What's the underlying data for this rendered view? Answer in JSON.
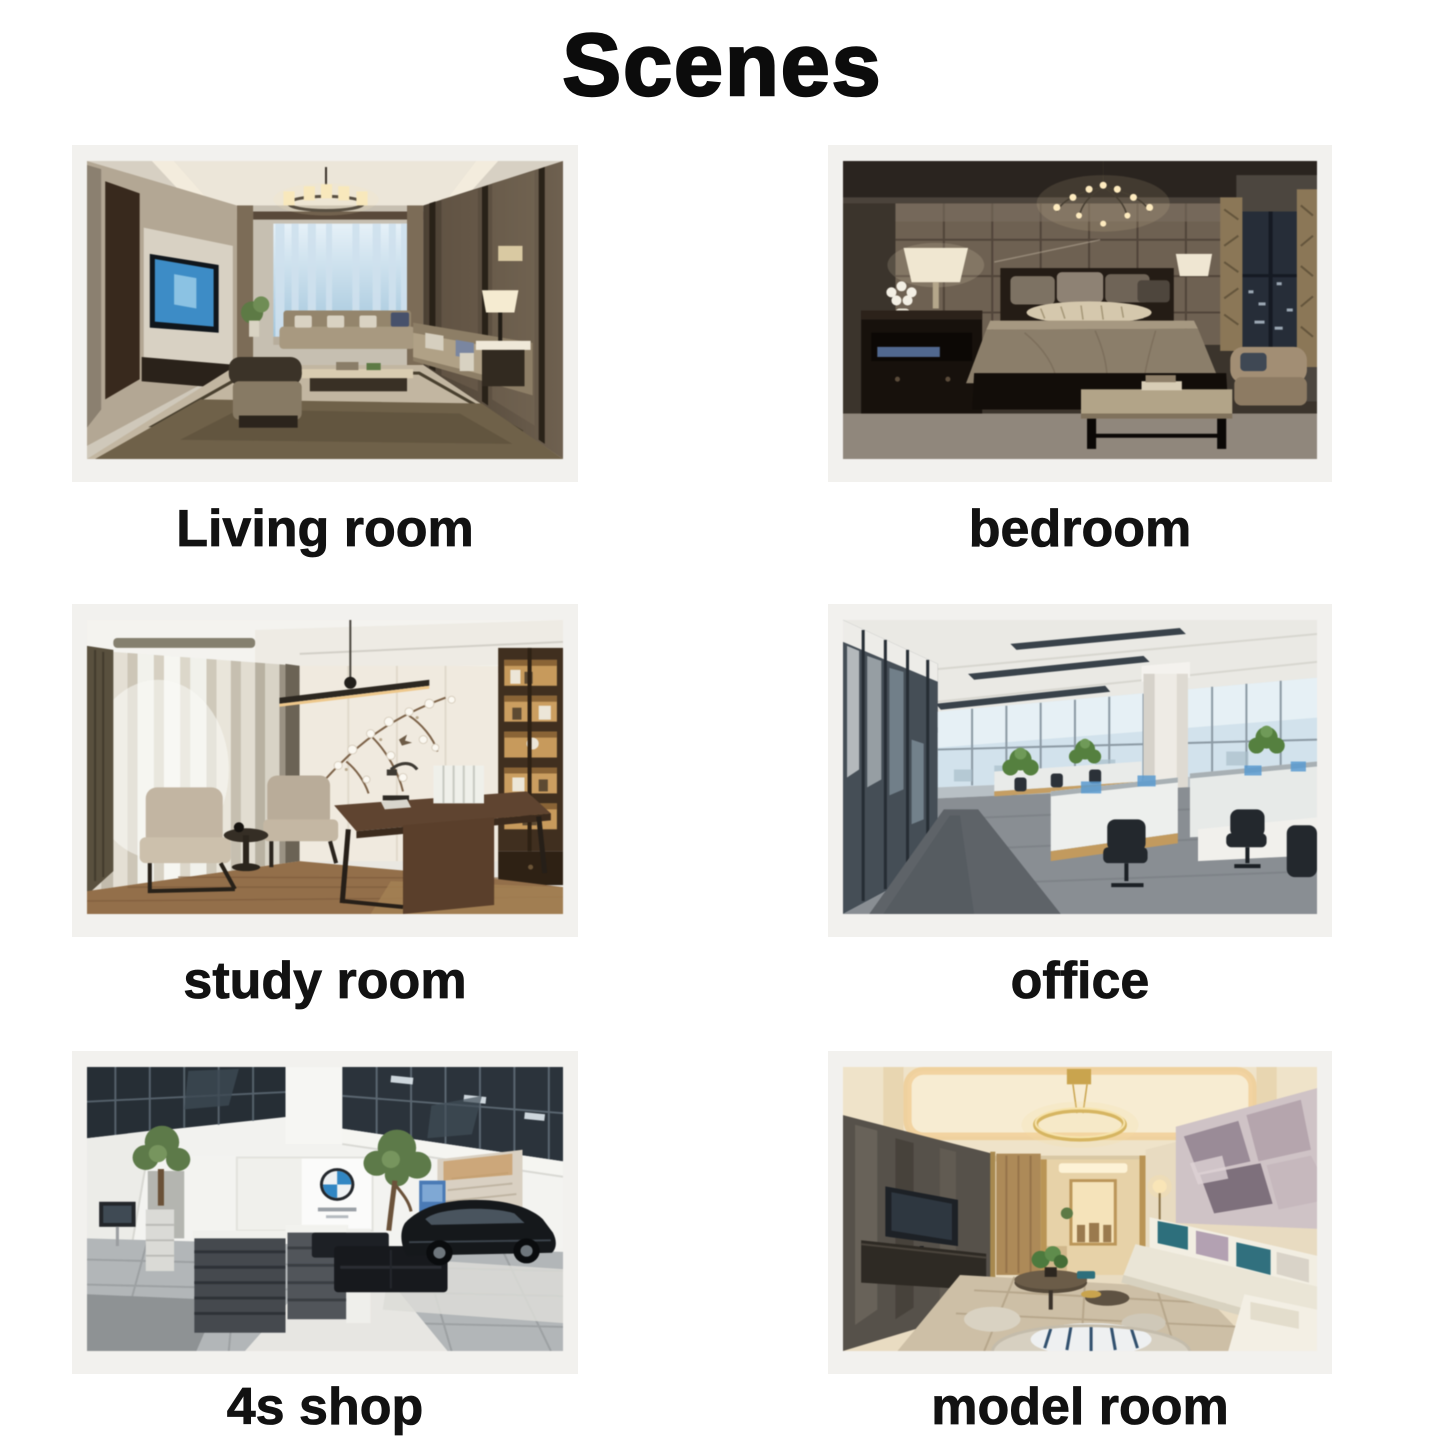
{
  "page": {
    "title": "Scenes"
  },
  "scenes": [
    {
      "id": "living-room",
      "label": "Living room"
    },
    {
      "id": "bedroom",
      "label": "bedroom"
    },
    {
      "id": "study-room",
      "label": "study room"
    },
    {
      "id": "office",
      "label": "office"
    },
    {
      "id": "4s-shop",
      "label": "4s shop"
    },
    {
      "id": "model-room",
      "label": "model room"
    }
  ],
  "colors": {
    "page_background": "#ffffff",
    "card_background": "#f2f1ee",
    "text": "#121212",
    "bmw_roundel_blue": "#3186c3"
  }
}
